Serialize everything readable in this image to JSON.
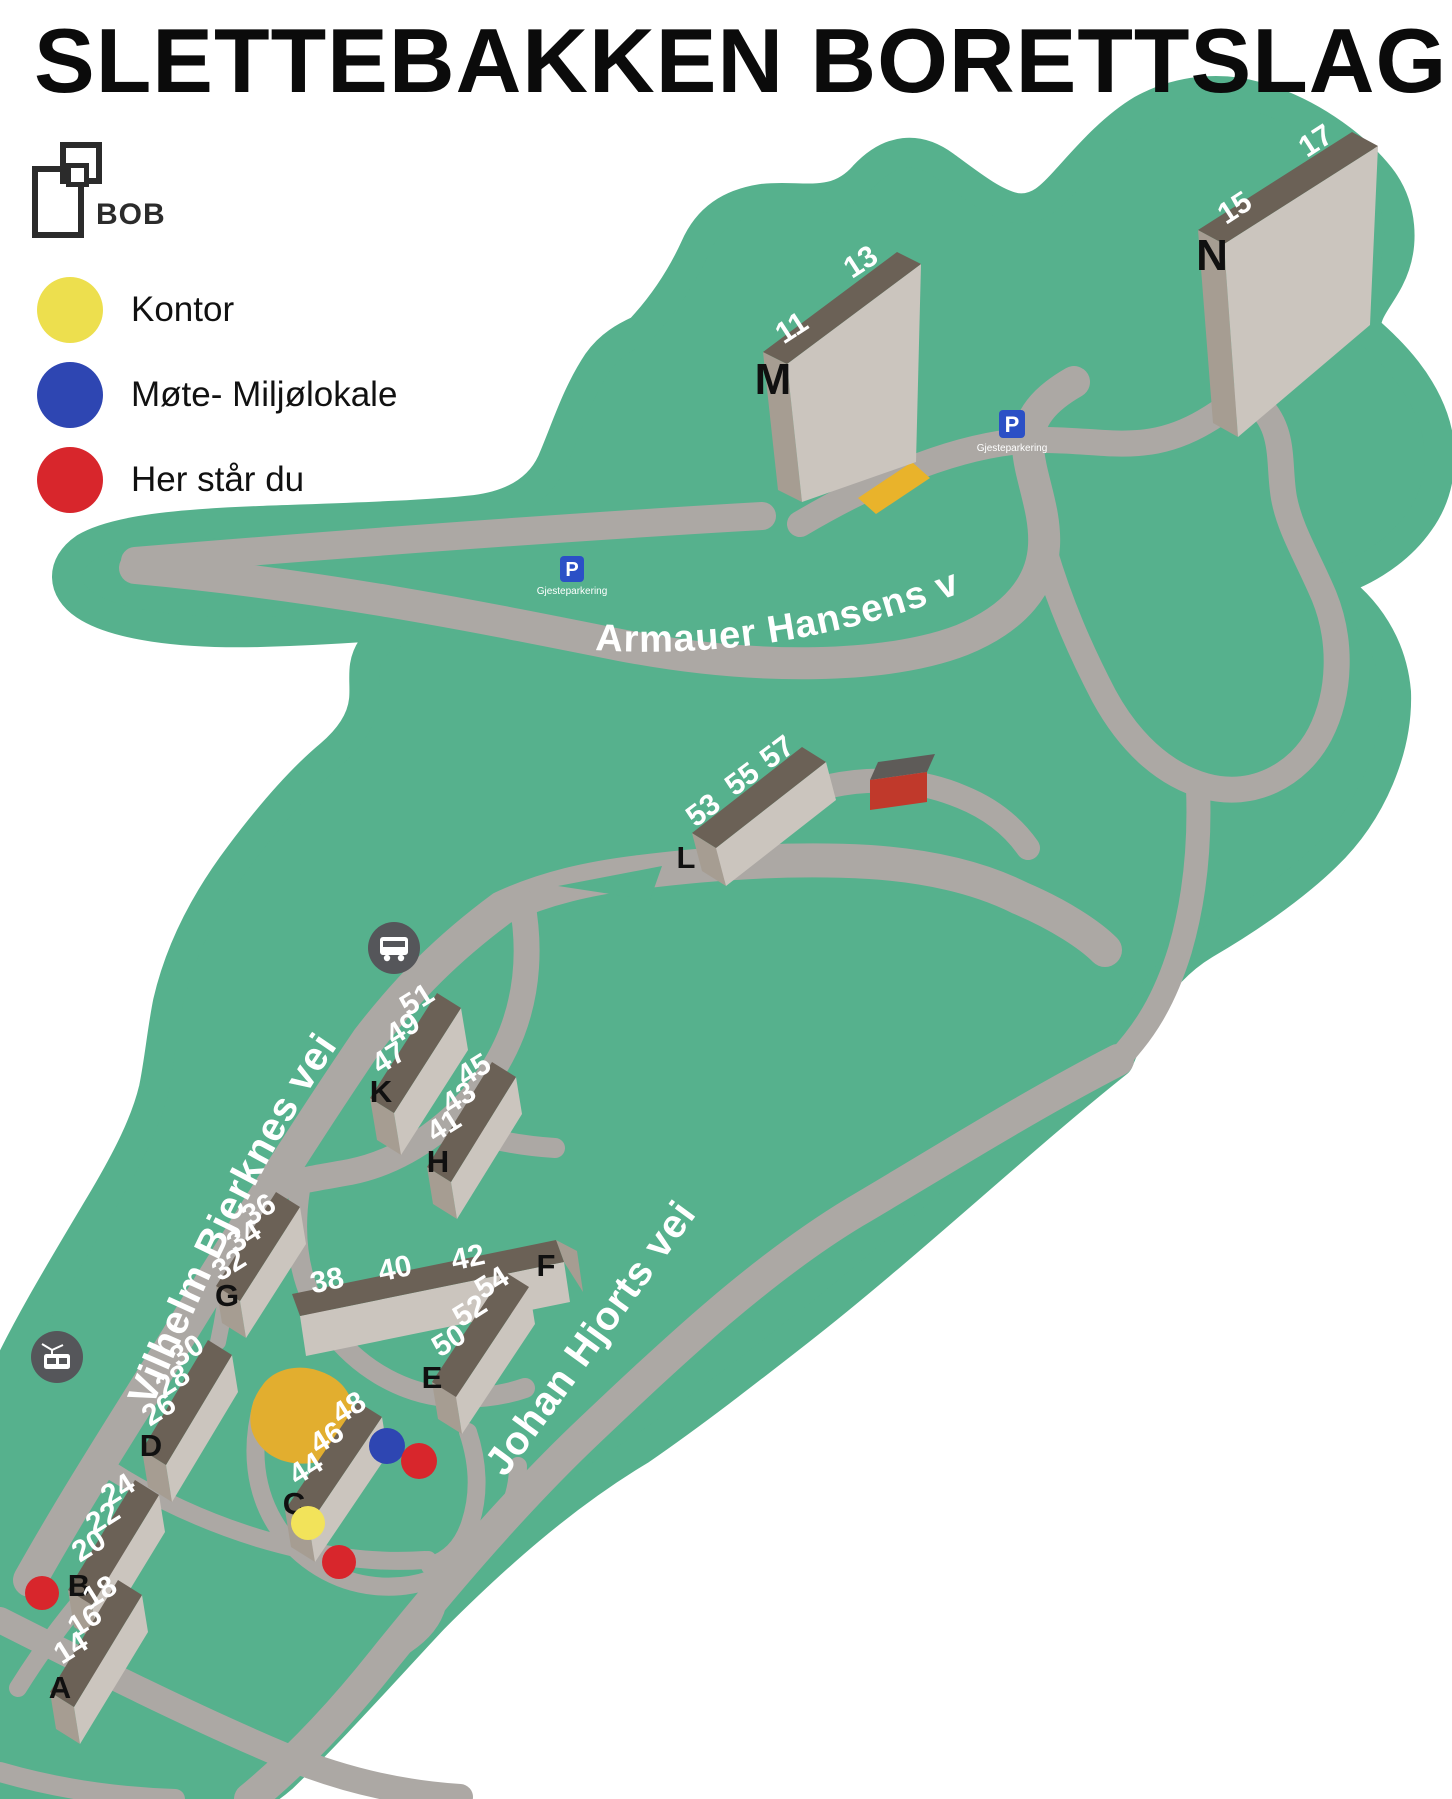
{
  "title": "SLETTEBAKKEN BORETTSLAG",
  "logo": {
    "name": "BOB"
  },
  "legend": {
    "items": [
      {
        "id": "office",
        "label": "Kontor",
        "color": "#EDDF4E"
      },
      {
        "id": "meeting",
        "label": "Møte- Miljølokale",
        "color": "#2E46B2"
      },
      {
        "id": "you-are-here",
        "label": "Her står du",
        "color": "#D8262C"
      }
    ]
  },
  "map": {
    "colors": {
      "ground": "#56B18D",
      "road": "#ACA8A4",
      "roof": "#6B6156",
      "building_front": "#CBC5BE",
      "building_side": "#A69D92",
      "office_area": "#E2AE2F",
      "parking_strip": "#E9B32B",
      "parking_sign": "#2B50C6",
      "shed_red": "#C0392B",
      "icon_circle": "#55565A"
    },
    "streets": [
      {
        "name": "Armauer Hansens vei"
      },
      {
        "name": "Vilhelm Bjerknes vei"
      },
      {
        "name": "Johan Hjorts vei"
      }
    ],
    "parking": {
      "symbol": "P",
      "caption": "Gjesteparkering"
    },
    "icons": [
      "bus-icon",
      "tram-icon",
      "parking-icon"
    ],
    "buildings": [
      {
        "letter": "A",
        "numbers": [
          "14",
          "16",
          "18"
        ]
      },
      {
        "letter": "B",
        "numbers": [
          "20",
          "22",
          "24"
        ]
      },
      {
        "letter": "C",
        "numbers": [
          "44",
          "46",
          "48"
        ]
      },
      {
        "letter": "D",
        "numbers": [
          "26",
          "28",
          "30"
        ]
      },
      {
        "letter": "E",
        "numbers": [
          "50",
          "52",
          "54"
        ]
      },
      {
        "letter": "F",
        "numbers": [
          "38",
          "40",
          "42"
        ]
      },
      {
        "letter": "G",
        "numbers": [
          "32",
          "34",
          "36"
        ]
      },
      {
        "letter": "H",
        "numbers": [
          "41",
          "43",
          "45"
        ]
      },
      {
        "letter": "K",
        "numbers": [
          "47",
          "49",
          "51"
        ]
      },
      {
        "letter": "L",
        "numbers": [
          "53",
          "55",
          "57"
        ]
      },
      {
        "letter": "M",
        "numbers": [
          "11",
          "13"
        ]
      },
      {
        "letter": "N",
        "numbers": [
          "15",
          "17"
        ]
      }
    ],
    "markers": {
      "you_are_here_count": 3,
      "meeting_count": 1,
      "office_count": 1
    }
  }
}
